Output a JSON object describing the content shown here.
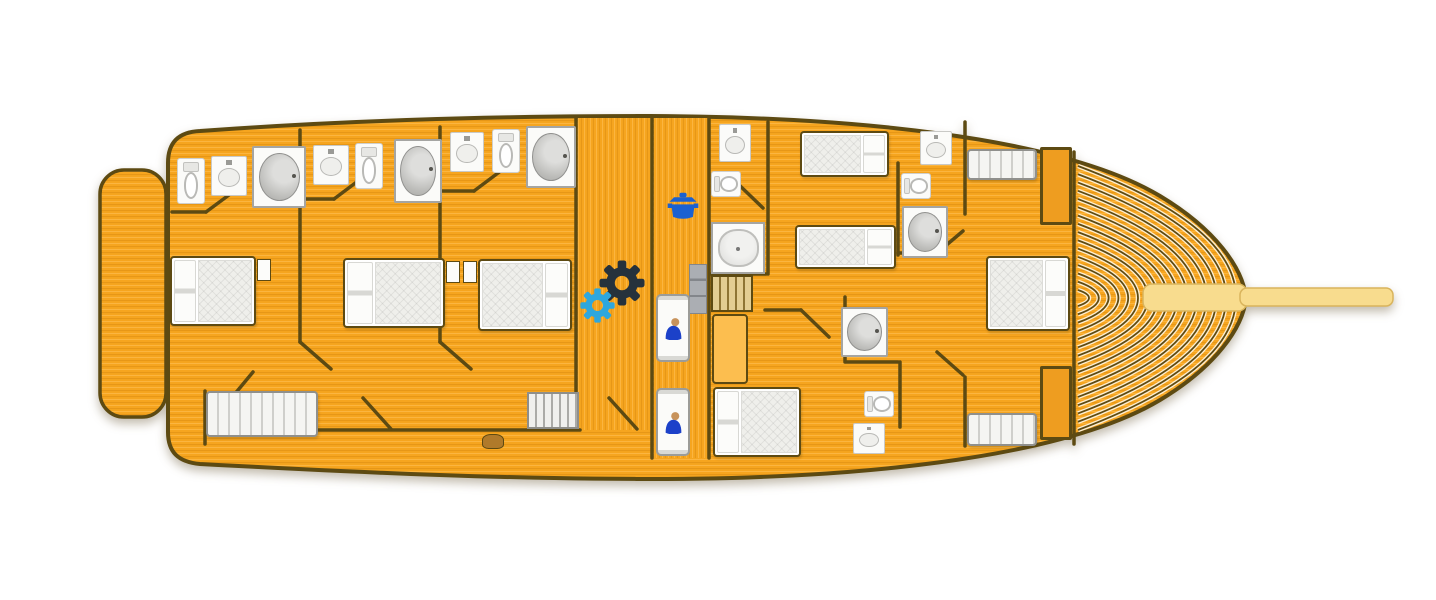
{
  "meta": {
    "label": "Gulet yacht lower deck floor plan",
    "width": 1436,
    "height": 600
  },
  "colors": {
    "deck": "#F6A51F",
    "deck_dark": "#DE8D13",
    "deck_light": "#FFC35B",
    "outline": "#5D4A12",
    "bowsprit": "#F8DC8E",
    "bowsprit_edge": "#D9B45C",
    "fixture_white": "#FBFBF9",
    "fixture_border": "#A5A5A2",
    "mattress": "#EFEFEB",
    "sofa_stripe": "#CFCFCB",
    "stairs_wood": "#E3CD92",
    "stairs_wood_dark": "#8E7434",
    "stairs_light": "#F0F0ED",
    "stairs_light_dark": "#ABABA7",
    "cabinet": "#ABAEB3",
    "table": "#FCBE4F",
    "wardrobe": "#EE9D20",
    "pot": "#1B61D1",
    "gear_dark": "#26323C",
    "gear_blue": "#2EA7DE",
    "crew": "#1C41C9",
    "skin": "#C8935C"
  },
  "hull": {
    "deck_path": "M 200 131 C 350 120 500 116 650 116 C 880 117 1070 142 1160 196 C 1215 229 1243 268 1246 298 C 1243 328 1215 367 1160 400 C 1070 454 880 479 650 479 C 500 479 350 472 200 464 C 178 462 168 452 168 432 L 168 163 C 168 143 178 132 200 131 Z",
    "swim_platform": {
      "x": 100,
      "y": 170,
      "w": 66,
      "h": 247,
      "r": 24
    },
    "vertical_grain_areas": [
      {
        "x": 578,
        "y": 118,
        "w": 73,
        "h": 312
      },
      {
        "x": 654,
        "y": 118,
        "w": 54,
        "h": 340
      }
    ],
    "bowsprit": [
      {
        "x": 1143,
        "y": 284,
        "w": 104,
        "h": 27,
        "r": 9
      },
      {
        "x": 1240,
        "y": 288,
        "w": 153,
        "h": 18,
        "r": 7
      }
    ],
    "bow_planking": {
      "x0": 1078,
      "cy": 298,
      "tip": 1236,
      "innermost": 1089,
      "count": 16,
      "h_max": 132,
      "h_min": 8
    }
  },
  "walls": [
    [
      300,
      130,
      300,
      342
    ],
    [
      300,
      342,
      331,
      369
    ],
    [
      440,
      127,
      440,
      342
    ],
    [
      440,
      342,
      471,
      369
    ],
    [
      576,
      117,
      576,
      392
    ],
    [
      652,
      117,
      652,
      458
    ],
    [
      709,
      118,
      709,
      458
    ],
    [
      172,
      212,
      206,
      212
    ],
    [
      206,
      212,
      237,
      189
    ],
    [
      300,
      199,
      334,
      199
    ],
    [
      334,
      199,
      362,
      178
    ],
    [
      440,
      191,
      474,
      191
    ],
    [
      474,
      191,
      502,
      170
    ],
    [
      205,
      391,
      205,
      444
    ],
    [
      236,
      430,
      580,
      430
    ],
    [
      253,
      372,
      224,
      407
    ],
    [
      363,
      398,
      391,
      429
    ],
    [
      609,
      398,
      637,
      429
    ],
    [
      768,
      122,
      768,
      274
    ],
    [
      711,
      274,
      766,
      274
    ],
    [
      736,
      182,
      763,
      208
    ],
    [
      765,
      310,
      801,
      310
    ],
    [
      801,
      310,
      829,
      337
    ],
    [
      898,
      163,
      898,
      255
    ],
    [
      898,
      253,
      937,
      253
    ],
    [
      937,
      253,
      963,
      231
    ],
    [
      965,
      122,
      965,
      214
    ],
    [
      845,
      297,
      845,
      362
    ],
    [
      846,
      362,
      898,
      362
    ],
    [
      900,
      362,
      900,
      427
    ],
    [
      937,
      352,
      963,
      375
    ],
    [
      965,
      377,
      965,
      446
    ],
    [
      1074,
      152,
      1074,
      444
    ]
  ],
  "fixtures": [
    {
      "name": "double-bed-aft-cabin-1",
      "cls": "bed",
      "x": 170,
      "y": 256,
      "w": 86,
      "h": 70,
      "pillow": "left"
    },
    {
      "name": "double-bed-aft-cabin-2",
      "cls": "bed",
      "x": 343,
      "y": 258,
      "w": 102,
      "h": 70,
      "pillow": "left"
    },
    {
      "name": "double-bed-aft-cabin-3",
      "cls": "bed",
      "x": 478,
      "y": 259,
      "w": 94,
      "h": 72,
      "pillow": "right"
    },
    {
      "name": "double-bed-mid-cabin",
      "cls": "bed",
      "x": 713,
      "y": 387,
      "w": 88,
      "h": 70,
      "pillow": "left"
    },
    {
      "name": "double-bed-bow-cabin",
      "cls": "bed",
      "x": 986,
      "y": 256,
      "w": 84,
      "h": 75,
      "pillow": "right"
    },
    {
      "name": "single-bed-mid-1",
      "cls": "bed",
      "x": 800,
      "y": 131,
      "w": 89,
      "h": 46,
      "pillow": "right"
    },
    {
      "name": "single-bed-mid-2",
      "cls": "bed",
      "x": 795,
      "y": 225,
      "w": 101,
      "h": 44,
      "pillow": "right"
    },
    {
      "name": "sofa-aft-cabin",
      "cls": "sofa",
      "x": 206,
      "y": 391,
      "w": 112,
      "h": 46
    },
    {
      "name": "settee-bow-port",
      "cls": "sofa",
      "x": 967,
      "y": 149,
      "w": 70,
      "h": 31
    },
    {
      "name": "settee-bow-starboard",
      "cls": "sofa",
      "x": 967,
      "y": 413,
      "w": 70,
      "h": 33
    },
    {
      "name": "wardrobe-bow-port",
      "cls": "wrd",
      "x": 1040,
      "y": 147,
      "w": 32,
      "h": 78
    },
    {
      "name": "wardrobe-bow-starboard",
      "cls": "wrd",
      "x": 1040,
      "y": 366,
      "w": 32,
      "h": 74
    },
    {
      "name": "toilet-aft-cabin-1",
      "cls": "toilet",
      "x": 177,
      "y": 158,
      "w": 28,
      "h": 46
    },
    {
      "name": "toilet-aft-cabin-2",
      "cls": "toilet",
      "x": 355,
      "y": 143,
      "w": 28,
      "h": 46
    },
    {
      "name": "toilet-aft-cabin-3",
      "cls": "toilet",
      "x": 492,
      "y": 129,
      "w": 28,
      "h": 44
    },
    {
      "name": "toilet-galley-bathroom",
      "cls": "toilet h",
      "x": 711,
      "y": 171,
      "w": 30,
      "h": 26
    },
    {
      "name": "toilet-mid-bathroom",
      "cls": "toilet h",
      "x": 901,
      "y": 173,
      "w": 30,
      "h": 26
    },
    {
      "name": "toilet-bow-bathroom",
      "cls": "toilet h",
      "x": 864,
      "y": 391,
      "w": 30,
      "h": 26
    },
    {
      "name": "sink-aft-cabin-1",
      "cls": "sink",
      "x": 211,
      "y": 156,
      "w": 36,
      "h": 40
    },
    {
      "name": "sink-aft-cabin-2",
      "cls": "sink",
      "x": 313,
      "y": 145,
      "w": 36,
      "h": 40
    },
    {
      "name": "sink-aft-cabin-3",
      "cls": "sink",
      "x": 450,
      "y": 132,
      "w": 34,
      "h": 40
    },
    {
      "name": "sink-galley-bathroom",
      "cls": "sink",
      "x": 719,
      "y": 124,
      "w": 32,
      "h": 38
    },
    {
      "name": "sink-mid-bathroom",
      "cls": "sink",
      "x": 920,
      "y": 131,
      "w": 32,
      "h": 34
    },
    {
      "name": "sink-bow-bathroom",
      "cls": "sink",
      "x": 853,
      "y": 423,
      "w": 32,
      "h": 31
    },
    {
      "name": "shower-aft-cabin-1",
      "cls": "shower",
      "x": 252,
      "y": 146,
      "w": 54,
      "h": 62
    },
    {
      "name": "shower-aft-cabin-2",
      "cls": "shower",
      "x": 394,
      "y": 139,
      "w": 48,
      "h": 64
    },
    {
      "name": "shower-aft-cabin-3",
      "cls": "shower",
      "x": 526,
      "y": 126,
      "w": 50,
      "h": 62
    },
    {
      "name": "shower-mid-bathroom",
      "cls": "shower",
      "x": 902,
      "y": 206,
      "w": 46,
      "h": 52
    },
    {
      "name": "shower-bow-bathroom",
      "cls": "shower",
      "x": 841,
      "y": 307,
      "w": 47,
      "h": 50
    },
    {
      "name": "bathtub-galley-bathroom",
      "cls": "tub",
      "x": 711,
      "y": 222,
      "w": 54,
      "h": 52
    },
    {
      "name": "staircase-main",
      "cls": "stairs",
      "x": 711,
      "y": 275,
      "w": 42,
      "h": 37
    },
    {
      "name": "staircase-aft-corridor",
      "cls": "stairs light",
      "x": 527,
      "y": 392,
      "w": 52,
      "h": 37
    },
    {
      "name": "cabinet-fridge",
      "cls": "cab",
      "x": 689,
      "y": 264,
      "w": 18,
      "h": 50
    },
    {
      "name": "table-mid-cabin",
      "cls": "table",
      "x": 712,
      "y": 314,
      "w": 36,
      "h": 70
    },
    {
      "name": "crew-berth-1",
      "cls": "berth",
      "tpl": "tpl-person",
      "x": 656,
      "y": 294,
      "w": 34,
      "h": 68
    },
    {
      "name": "crew-berth-2",
      "cls": "berth",
      "tpl": "tpl-person",
      "x": 656,
      "y": 388,
      "w": 34,
      "h": 68
    },
    {
      "name": "step-aft-corridor",
      "cls": "step",
      "x": 482,
      "y": 434,
      "w": 22,
      "h": 15
    },
    {
      "name": "nightstand-aft-cabin-1",
      "cls": "nst",
      "x": 257,
      "y": 259,
      "w": 14,
      "h": 22
    },
    {
      "name": "nightstand-aft-cabin-2",
      "cls": "nst",
      "x": 446,
      "y": 261,
      "w": 14,
      "h": 22
    },
    {
      "name": "nightstand-aft-cabin-3",
      "cls": "nst",
      "x": 463,
      "y": 261,
      "w": 14,
      "h": 22
    },
    {
      "name": "cooking-pot-icon",
      "cls": "icon",
      "tpl": "tpl-pot",
      "x": 665,
      "y": 191,
      "w": 36,
      "h": 34,
      "color": "#1B61D1"
    },
    {
      "name": "gear-icon-dark",
      "cls": "icon",
      "tpl": "tpl-gear",
      "x": 599,
      "y": 260,
      "w": 46,
      "h": 46,
      "color": "#26323C"
    },
    {
      "name": "gear-icon-blue",
      "cls": "icon",
      "tpl": "tpl-gear",
      "x": 580,
      "y": 288,
      "w": 35,
      "h": 35,
      "color": "#2EA7DE"
    }
  ]
}
